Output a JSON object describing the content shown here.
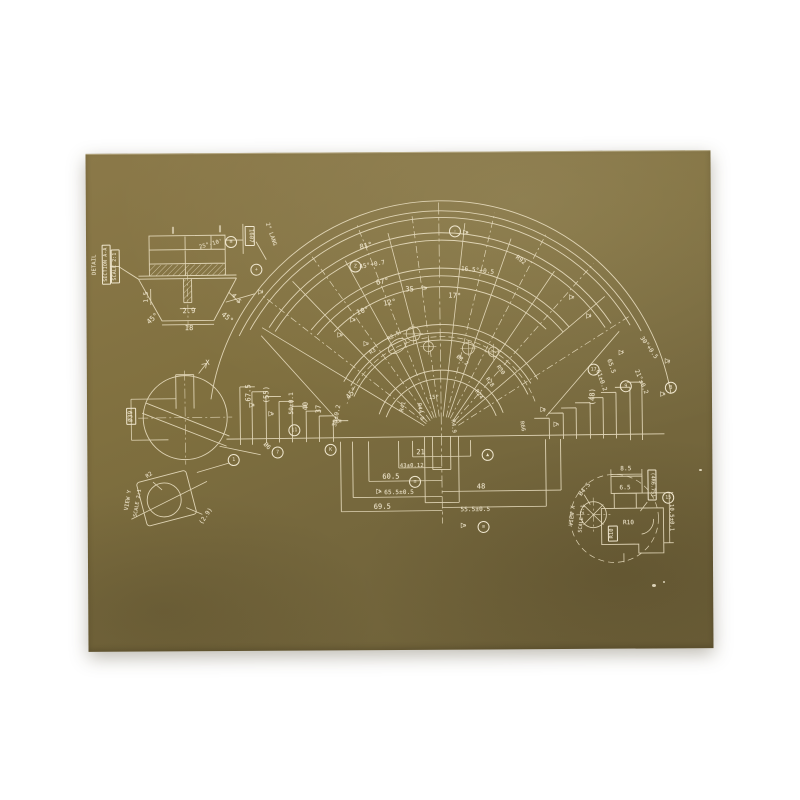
{
  "scene": {
    "background_color": "#ffffff",
    "sheet": {
      "color_top": "#8b7949",
      "color_mid": "#7d6c42",
      "color_bottom": "#6c5f38",
      "line_color": "#e7dcbe",
      "ink_color": "#f0e7cf"
    },
    "glyphs": {
      "flag": "▷"
    }
  },
  "annotations": {
    "main_view": {
      "labels": [
        {
          "t": "81°",
          "x": 368,
          "y": 246,
          "r": -12
        },
        {
          "t": "45°+0.7",
          "x": 374,
          "y": 265,
          "r": -10,
          "s": 6
        },
        {
          "t": "67°",
          "x": 384,
          "y": 282,
          "r": -10
        },
        {
          "t": "35",
          "x": 411,
          "y": 290,
          "r": 0
        },
        {
          "t": "16.5°+0.5",
          "x": 479,
          "y": 272,
          "r": 7,
          "s": 6
        },
        {
          "t": "17°",
          "x": 456,
          "y": 297,
          "r": 4
        },
        {
          "t": "12°",
          "x": 391,
          "y": 303,
          "r": -10
        },
        {
          "t": "10°",
          "x": 364,
          "y": 311,
          "r": -18
        },
        {
          "t": "R92",
          "x": 522,
          "y": 262,
          "r": 38,
          "s": 6
        },
        {
          "t": "30°+0.5",
          "x": 649,
          "y": 351,
          "r": 55,
          "s": 6
        },
        {
          "t": "21°±0.2",
          "x": 641,
          "y": 385,
          "r": 68,
          "s": 6
        },
        {
          "t": "65.5",
          "x": 611,
          "y": 369,
          "r": 72,
          "s": 6
        },
        {
          "t": "61±0.2",
          "x": 601,
          "y": 383,
          "r": 72,
          "s": 6
        },
        {
          "t": "(48)",
          "x": 593,
          "y": 399,
          "r": -90
        },
        {
          "t": "67.5",
          "x": 249,
          "y": 391,
          "r": -90
        },
        {
          "t": "(55)",
          "x": 267,
          "y": 393,
          "r": -90
        },
        {
          "t": "50±0.1",
          "x": 292,
          "y": 402,
          "r": -90,
          "s": 6
        },
        {
          "t": "40",
          "x": 306,
          "y": 405,
          "r": -90
        },
        {
          "t": "37",
          "x": 319,
          "y": 408,
          "r": -90
        },
        {
          "t": "30±0.2",
          "x": 337,
          "y": 415,
          "r": -78,
          "s": 6
        },
        {
          "t": "45°",
          "x": 352,
          "y": 393,
          "r": -48
        },
        {
          "t": "21",
          "x": 420,
          "y": 453,
          "r": 0
        },
        {
          "t": "43±0.12",
          "x": 411,
          "y": 467,
          "r": 0,
          "s": 5.5
        },
        {
          "t": "60.5",
          "x": 390,
          "y": 477,
          "r": 0
        },
        {
          "t": "65.5±0.5",
          "x": 398,
          "y": 493,
          "r": 0,
          "s": 6
        },
        {
          "t": "69.5",
          "x": 381,
          "y": 507,
          "r": 0
        },
        {
          "t": "48",
          "x": 480,
          "y": 488,
          "r": 0
        },
        {
          "t": "55.5±0.5",
          "x": 474,
          "y": 511,
          "r": 0,
          "s": 6
        },
        {
          "t": "R28",
          "x": 489,
          "y": 384,
          "r": 55,
          "s": 5.5
        },
        {
          "t": "R30",
          "x": 500,
          "y": 372,
          "r": 55,
          "s": 5.5
        },
        {
          "t": "R24",
          "x": 478,
          "y": 396,
          "r": 55,
          "s": 5.5
        },
        {
          "t": "R44.9",
          "x": 419,
          "y": 412,
          "r": 80,
          "s": 5.5
        },
        {
          "t": "R41",
          "x": 404,
          "y": 407,
          "r": -75,
          "s": 5.5
        },
        {
          "t": "15°",
          "x": 434,
          "y": 399,
          "r": 0,
          "s": 5.5
        },
        {
          "t": "R4.9",
          "x": 452,
          "y": 427,
          "r": 85,
          "s": 5.5
        },
        {
          "t": "R66",
          "x": 521,
          "y": 428,
          "r": 80,
          "s": 5.5
        },
        {
          "t": "R3",
          "x": 374,
          "y": 352,
          "r": -35,
          "s": 5.5
        },
        {
          "t": "R2.5",
          "x": 395,
          "y": 337,
          "r": -30,
          "s": 5.5
        },
        {
          "t": "Ø8.2",
          "x": 462,
          "y": 362,
          "r": 40,
          "s": 5.5
        }
      ],
      "circled": [
        {
          "t": "-",
          "x": 457,
          "y": 232
        },
        {
          "t": "Z",
          "x": 357,
          "y": 266
        },
        {
          "t": "B",
          "x": 671,
          "y": 391
        },
        {
          "t": "9",
          "x": 626,
          "y": 389
        },
        {
          "t": "17",
          "x": 594,
          "y": 372
        },
        {
          "t": "11",
          "x": 294,
          "y": 429
        },
        {
          "t": "≡",
          "x": 414,
          "y": 482
        },
        {
          "t": "≡",
          "x": 482,
          "y": 528
        },
        {
          "t": "▲",
          "x": 487,
          "y": 456
        },
        {
          "t": "K",
          "x": 330,
          "y": 449
        }
      ],
      "flags": [
        {
          "t": "e",
          "x": 468,
          "y": 234
        },
        {
          "t": "p",
          "x": 426,
          "y": 289
        },
        {
          "t": "a",
          "x": 354,
          "y": 320
        },
        {
          "t": "b",
          "x": 341,
          "y": 335
        },
        {
          "t": "c",
          "x": 367,
          "y": 344
        },
        {
          "t": "a",
          "x": 252,
          "y": 404
        },
        {
          "t": "b",
          "x": 271,
          "y": 413
        },
        {
          "t": "c",
          "x": 339,
          "y": 421
        },
        {
          "t": "e",
          "x": 573,
          "y": 300
        },
        {
          "t": "d",
          "x": 590,
          "y": 319
        },
        {
          "t": "f",
          "x": 622,
          "y": 356
        },
        {
          "t": "g",
          "x": 668,
          "y": 365
        },
        {
          "t": "h",
          "x": 663,
          "y": 398
        },
        {
          "t": "k",
          "x": 378,
          "y": 492
        },
        {
          "t": "m",
          "x": 462,
          "y": 527
        },
        {
          "t": "g",
          "x": 543,
          "y": 412
        },
        {
          "t": "h",
          "x": 556,
          "y": 427
        }
      ]
    },
    "section_detail": {
      "labels": [
        {
          "t": "∥",
          "x": 175,
          "y": 228,
          "r": 0
        },
        {
          "t": "∥",
          "x": 222,
          "y": 227,
          "r": 0
        },
        {
          "t": "25°-10'",
          "x": 213,
          "y": 243,
          "r": -15,
          "s": 5.5
        },
        {
          "t": "2.9",
          "x": 190,
          "y": 309,
          "r": 0
        },
        {
          "t": "18",
          "x": 190,
          "y": 326,
          "r": 0
        },
        {
          "t": "45°",
          "x": 154,
          "y": 316,
          "r": -42
        },
        {
          "t": "45°",
          "x": 228,
          "y": 316,
          "r": 40
        },
        {
          "t": "1.5",
          "x": 148,
          "y": 294,
          "r": -90,
          "s": 6
        },
        {
          "t": "4.5",
          "x": 237,
          "y": 297,
          "r": 50,
          "s": 6
        },
        {
          "t": "2° LANG",
          "x": 272,
          "y": 233,
          "r": 72,
          "s": 5.5
        },
        {
          "t": "DETAIL",
          "x": 97,
          "y": 261,
          "r": -90,
          "s": 5.5
        }
      ],
      "boxed": [
        {
          "t": "SECTION A-A",
          "x": 108,
          "y": 261,
          "r": -90,
          "s": 5
        },
        {
          "t": "SCALE 2:1",
          "x": 117,
          "y": 263,
          "r": -90,
          "s": 5
        },
        {
          "t": "1607",
          "x": 252,
          "y": 234,
          "r": 90,
          "s": 5.5
        }
      ],
      "circled": [
        {
          "t": "≡",
          "x": 233,
          "y": 240
        },
        {
          "t": "+",
          "x": 258,
          "y": 268
        }
      ],
      "flags": [
        {
          "t": "d",
          "x": 262,
          "y": 291
        }
      ]
    },
    "circle_detail": {
      "labels": [
        {
          "t": "X",
          "x": 208,
          "y": 361,
          "r": 0
        },
        {
          "t": "Ø6",
          "x": 266,
          "y": 445,
          "r": 45,
          "s": 6
        }
      ],
      "boxed": [
        {
          "t": "Ø39",
          "x": 131,
          "y": 413,
          "r": -90,
          "s": 6
        }
      ],
      "circled": [
        {
          "t": "7",
          "x": 277,
          "y": 451
        }
      ],
      "flags": []
    },
    "corner_view": {
      "labels": [
        {
          "t": "R2",
          "x": 149,
          "y": 473,
          "r": -35,
          "s": 5.5
        },
        {
          "t": "VIEW Y",
          "x": 128,
          "y": 497,
          "r": -80,
          "s": 5.5
        },
        {
          "t": "SCALE 2:1",
          "x": 137,
          "y": 500,
          "r": -80,
          "s": 5
        },
        {
          "t": "(2.9)",
          "x": 205,
          "y": 514,
          "r": -55,
          "s": 6
        }
      ],
      "boxed": [],
      "circled": [
        {
          "t": "1",
          "x": 233,
          "y": 458
        }
      ],
      "flags": []
    },
    "scale_detail": {
      "labels": [
        {
          "t": "8.5",
          "x": 625,
          "y": 472,
          "r": 0,
          "s": 6
        },
        {
          "t": "6.5",
          "x": 624,
          "y": 491,
          "r": 0,
          "s": 6
        },
        {
          "t": "Ø4.5",
          "x": 584,
          "y": 492,
          "r": -50,
          "s": 6
        },
        {
          "t": "R10",
          "x": 627,
          "y": 526,
          "r": 0,
          "s": 6
        },
        {
          "t": "10.5±0.1",
          "x": 669,
          "y": 521,
          "r": 90,
          "s": 5.5
        },
        {
          "t": "VIEW X",
          "x": 572,
          "y": 518,
          "r": -83,
          "s": 5.5
        },
        {
          "t": "SCALE 2:1",
          "x": 581,
          "y": 521,
          "r": -83,
          "s": 5
        }
      ],
      "boxed": [
        {
          "t": "(4R6.75)",
          "x": 651,
          "y": 488,
          "r": 90,
          "s": 5
        },
        {
          "t": "R10",
          "x": 611,
          "y": 536,
          "r": -90,
          "s": 5.5
        }
      ],
      "circled": [
        {
          "t": "15",
          "x": 667,
          "y": 501
        }
      ],
      "flags": []
    }
  }
}
